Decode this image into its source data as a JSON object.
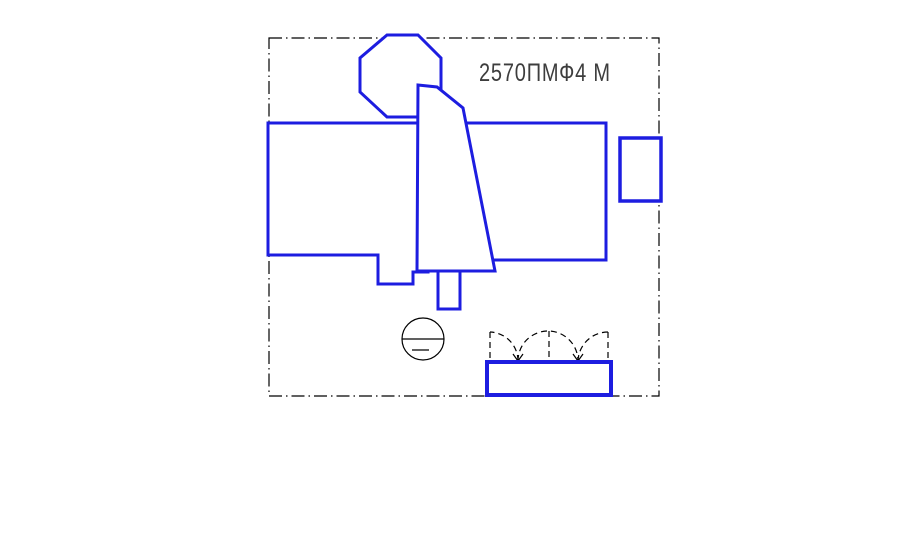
{
  "drawing": {
    "title": "2570ПМФ4 М"
  },
  "colors": {
    "machine_outline": "#1d1de0",
    "boundary_line": "#000000",
    "title_text": "#3d3d3d",
    "background": "#ffffff"
  },
  "symbols": {
    "operator_position": "circle-with-chord-symbol",
    "door_swing": "dashed-arc-swing-marks",
    "boundary": "dash-dot-layout-boundary"
  }
}
